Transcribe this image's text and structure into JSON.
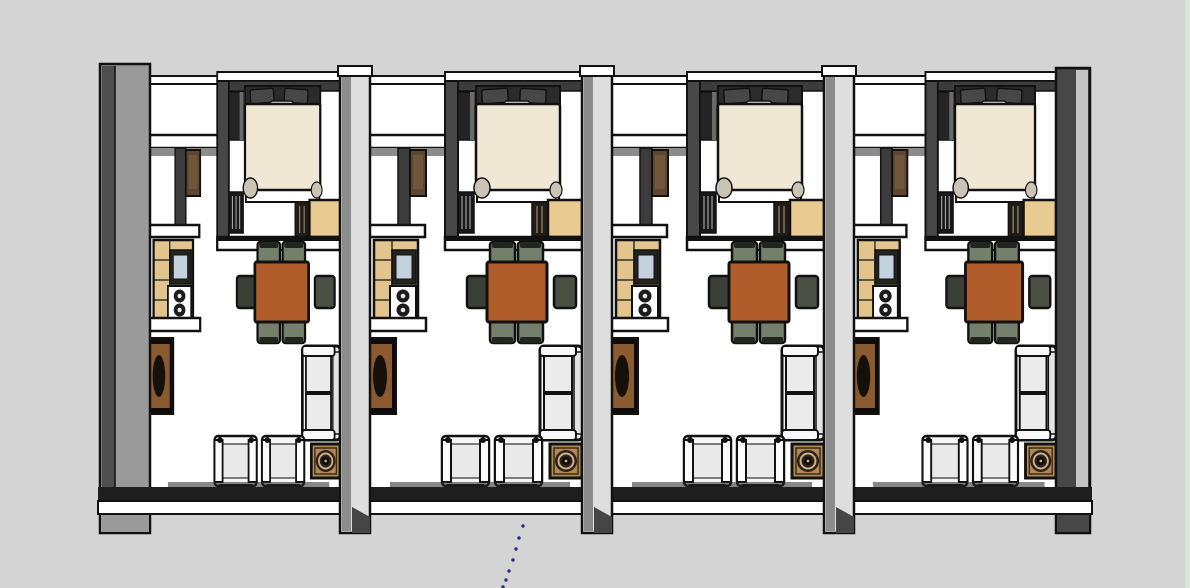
{
  "scene": {
    "type": "3d-floor-plan",
    "description": "Top-down perspective rendering of four identical studio apartment units in a row, SketchUp style",
    "unit_count": 4,
    "units": [
      {
        "id": "unit-1"
      },
      {
        "id": "unit-2"
      },
      {
        "id": "unit-3"
      },
      {
        "id": "unit-4"
      }
    ],
    "furniture_per_unit": [
      "double-bed-with-headboard-and-pillows",
      "nightstand",
      "side-cabinet",
      "wardrobe",
      "clothes-rack",
      "entry-door",
      "partition-shelf-upper",
      "partition-shelf-lower",
      "kitchen-counter-with-cabinets",
      "kitchen-sink",
      "two-burner-stove",
      "kitchen-shelf",
      "media-cabinet",
      "dining-table",
      "dining-chairs-x6",
      "two-seat-sofa",
      "washing-machine",
      "armchairs-x2"
    ],
    "annotation_line": {
      "style": "dotted",
      "direction": "downward from bottom wall",
      "color": "#2b2b8c"
    }
  },
  "palette": {
    "bg": "#d4d4d4",
    "floor": "#ffffff",
    "outline": "#111111",
    "wall-face": "#9a9a9a",
    "wall-dark": "#4f4f4f",
    "wall-deep": "#474747",
    "wall-light": "#dedede",
    "wall-stripe": "#8c8c8c",
    "bedroom-wall": "#3c3c3c",
    "cap-white": "#ffffff",
    "bed-duvet": "#f0e8d5",
    "bed-headboard": "#2b2b2b",
    "pillow": "#474747",
    "fold-grey": "#c9c4b4",
    "wood-tan": "#e9cb92",
    "counter-tan": "#e4c48d",
    "sink-blue": "#c3d2de",
    "table-brown": "#b05c2b",
    "chair-olive": "#75806c",
    "chair-dark": "#3a4036",
    "door-brown": "#5e4632",
    "cabinet-brown": "#8a5a30",
    "washer-tan": "#b08957",
    "washer-ring": "#c9b089",
    "sofa-white": "#f4f4f4",
    "cushion": "#ebebeb",
    "rack-dark": "#181818",
    "dot-blue": "#2b2b8c",
    "edge-green": "#d8e9d0"
  }
}
